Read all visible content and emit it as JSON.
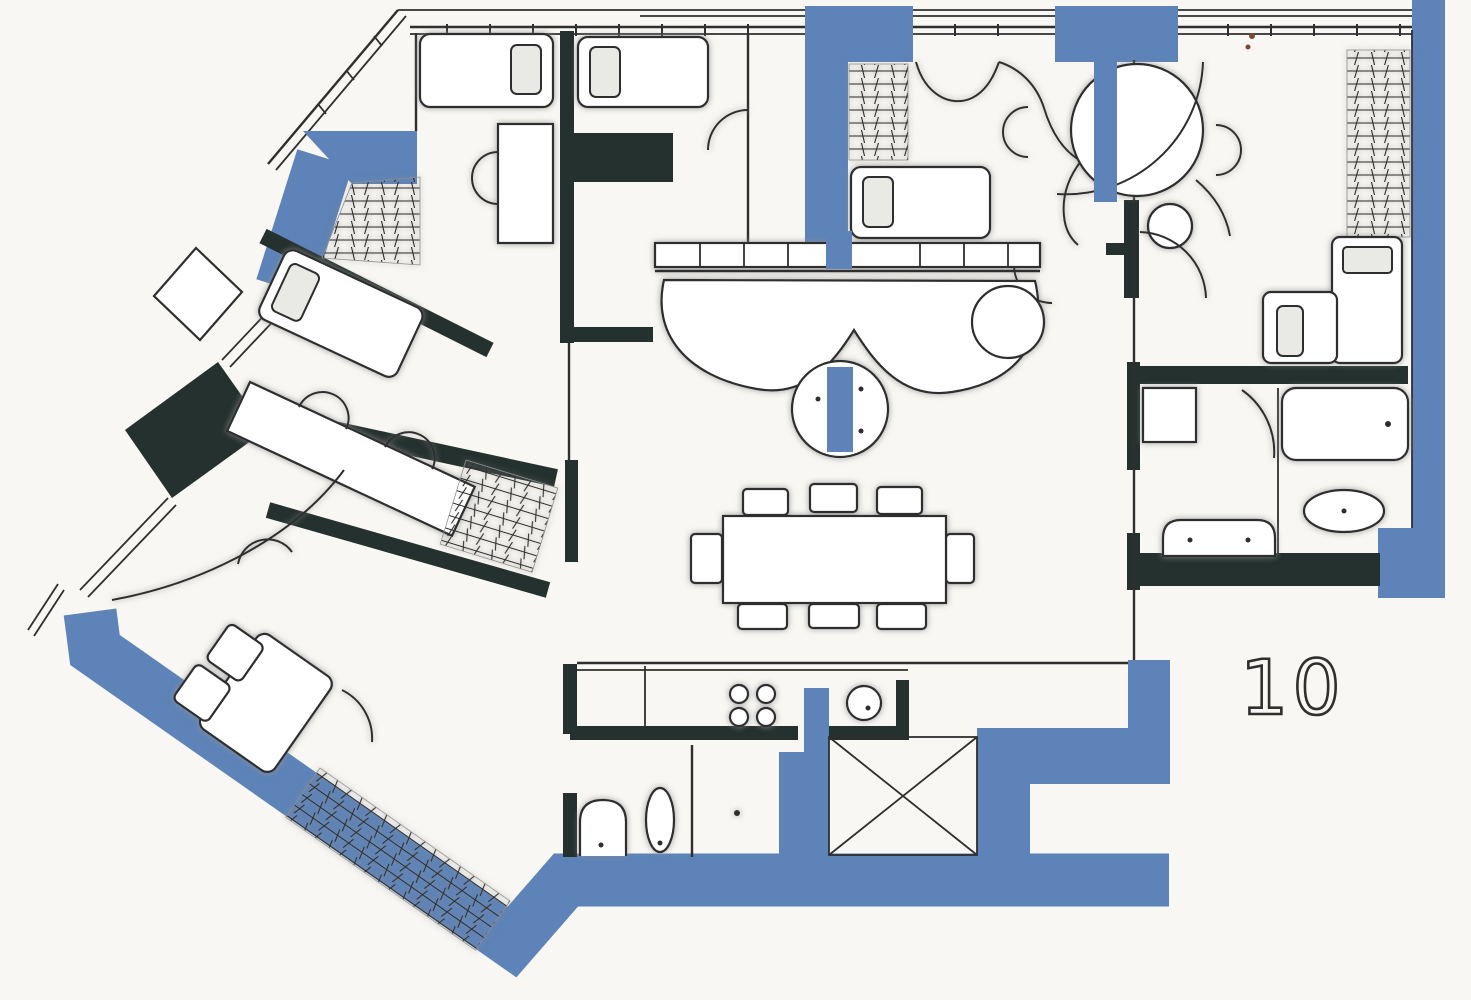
{
  "meta": {
    "plan_number": "10"
  },
  "palette": {
    "paper": "#f8f7f3",
    "wall_blue": "#5d83b8",
    "wall_dark": "#25312e",
    "ink": "#2f2f2f",
    "pencil": "#9b9b9f",
    "fixture_fill": "#ffffff",
    "pillow_fill": "#e9e9e6",
    "hatch_ink": "#2b2b2b",
    "speck": "#7c4a33"
  }
}
